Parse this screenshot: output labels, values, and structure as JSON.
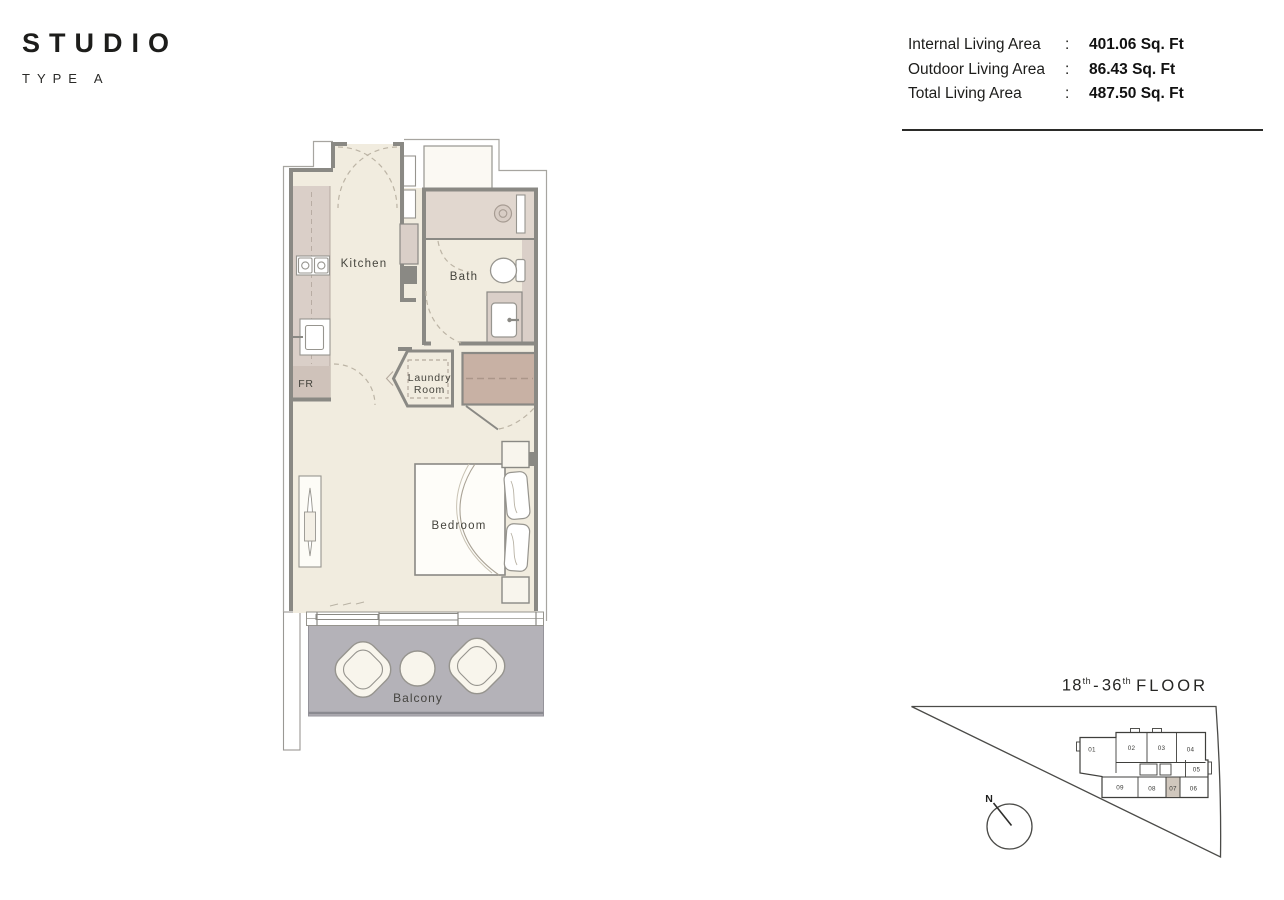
{
  "header": {
    "title": "STUDIO",
    "subtitle": "TYPE A"
  },
  "area_table": {
    "rows": [
      {
        "label": "Internal Living Area",
        "colon": ":",
        "value": "401.06 Sq. Ft"
      },
      {
        "label": "Outdoor Living Area",
        "colon": ":",
        "value": "86.43 Sq. Ft"
      },
      {
        "label": "Total Living Area",
        "colon": ":",
        "value": "487.50 Sq. Ft"
      }
    ]
  },
  "floorplan": {
    "labels": {
      "kitchen": "Kitchen",
      "bath": "Bath",
      "laundry_line1": "Laundry",
      "laundry_line2": "Room",
      "bedroom": "Bedroom",
      "balcony": "Balcony",
      "fridge": "FR"
    }
  },
  "siteplan": {
    "floor_range": {
      "from": "18",
      "from_sup": "th",
      "separator": "-",
      "to": "36",
      "to_sup": "th",
      "suffix": "FLOOR"
    },
    "compass_label": "N",
    "units": [
      {
        "label": "01"
      },
      {
        "label": "02"
      },
      {
        "label": "03"
      },
      {
        "label": "04"
      },
      {
        "label": "05"
      },
      {
        "label": "06"
      },
      {
        "label": "07"
      },
      {
        "label": "08"
      },
      {
        "label": "09"
      }
    ],
    "highlighted_unit": "07"
  },
  "colors": {
    "floor_cream": "#f1ecdf",
    "counter_pink": "#dacfc8",
    "shower_pink": "#e1d7cf",
    "fridge_pink": "#cfc2ba",
    "wardrobe_tan": "#c8b1a4",
    "balcony_gray": "#b4b2b8",
    "wall_gray": "#8a8984",
    "highlight_unit": "#d0c7bd"
  }
}
